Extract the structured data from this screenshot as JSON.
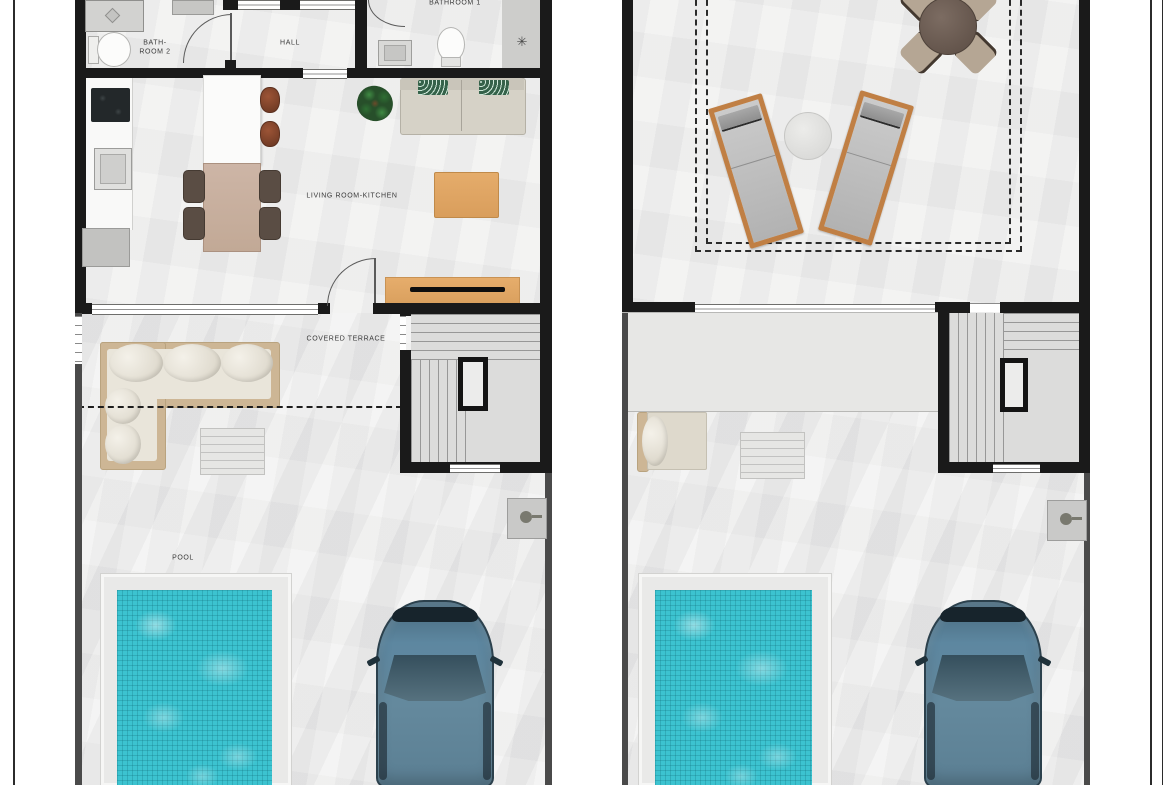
{
  "plans": {
    "left": {
      "labels": {
        "bathroom2_line1": "BATH-",
        "bathroom2_line2": "ROOM 2",
        "hall": "HALL",
        "bathroom1": "BATHROOM 1",
        "living_kitchen": "LIVING ROOM-KITCHEN",
        "covered_terrace": "COVERED TERRACE",
        "pool": "POOL"
      }
    },
    "right": {
      "labels": {}
    }
  },
  "icons": {
    "outdoor_shower_symbol": "✳"
  },
  "colors": {
    "wall": "#1a1a1a",
    "floor_tile": "#f1f1f0",
    "pool_water": "#3cc3d0",
    "pool_deck": "#e9e9e8",
    "car_body": "#5d87a0",
    "wood_furniture": "#e0a768",
    "lounger_wood": "#c07f44",
    "sofa_beige": "#d6d2c7",
    "pillow_green": "#35624a",
    "dining_table": "#c9b1a2",
    "outdoor_sofa_frame": "#cdb695",
    "roof_table": "#6e5e55"
  }
}
